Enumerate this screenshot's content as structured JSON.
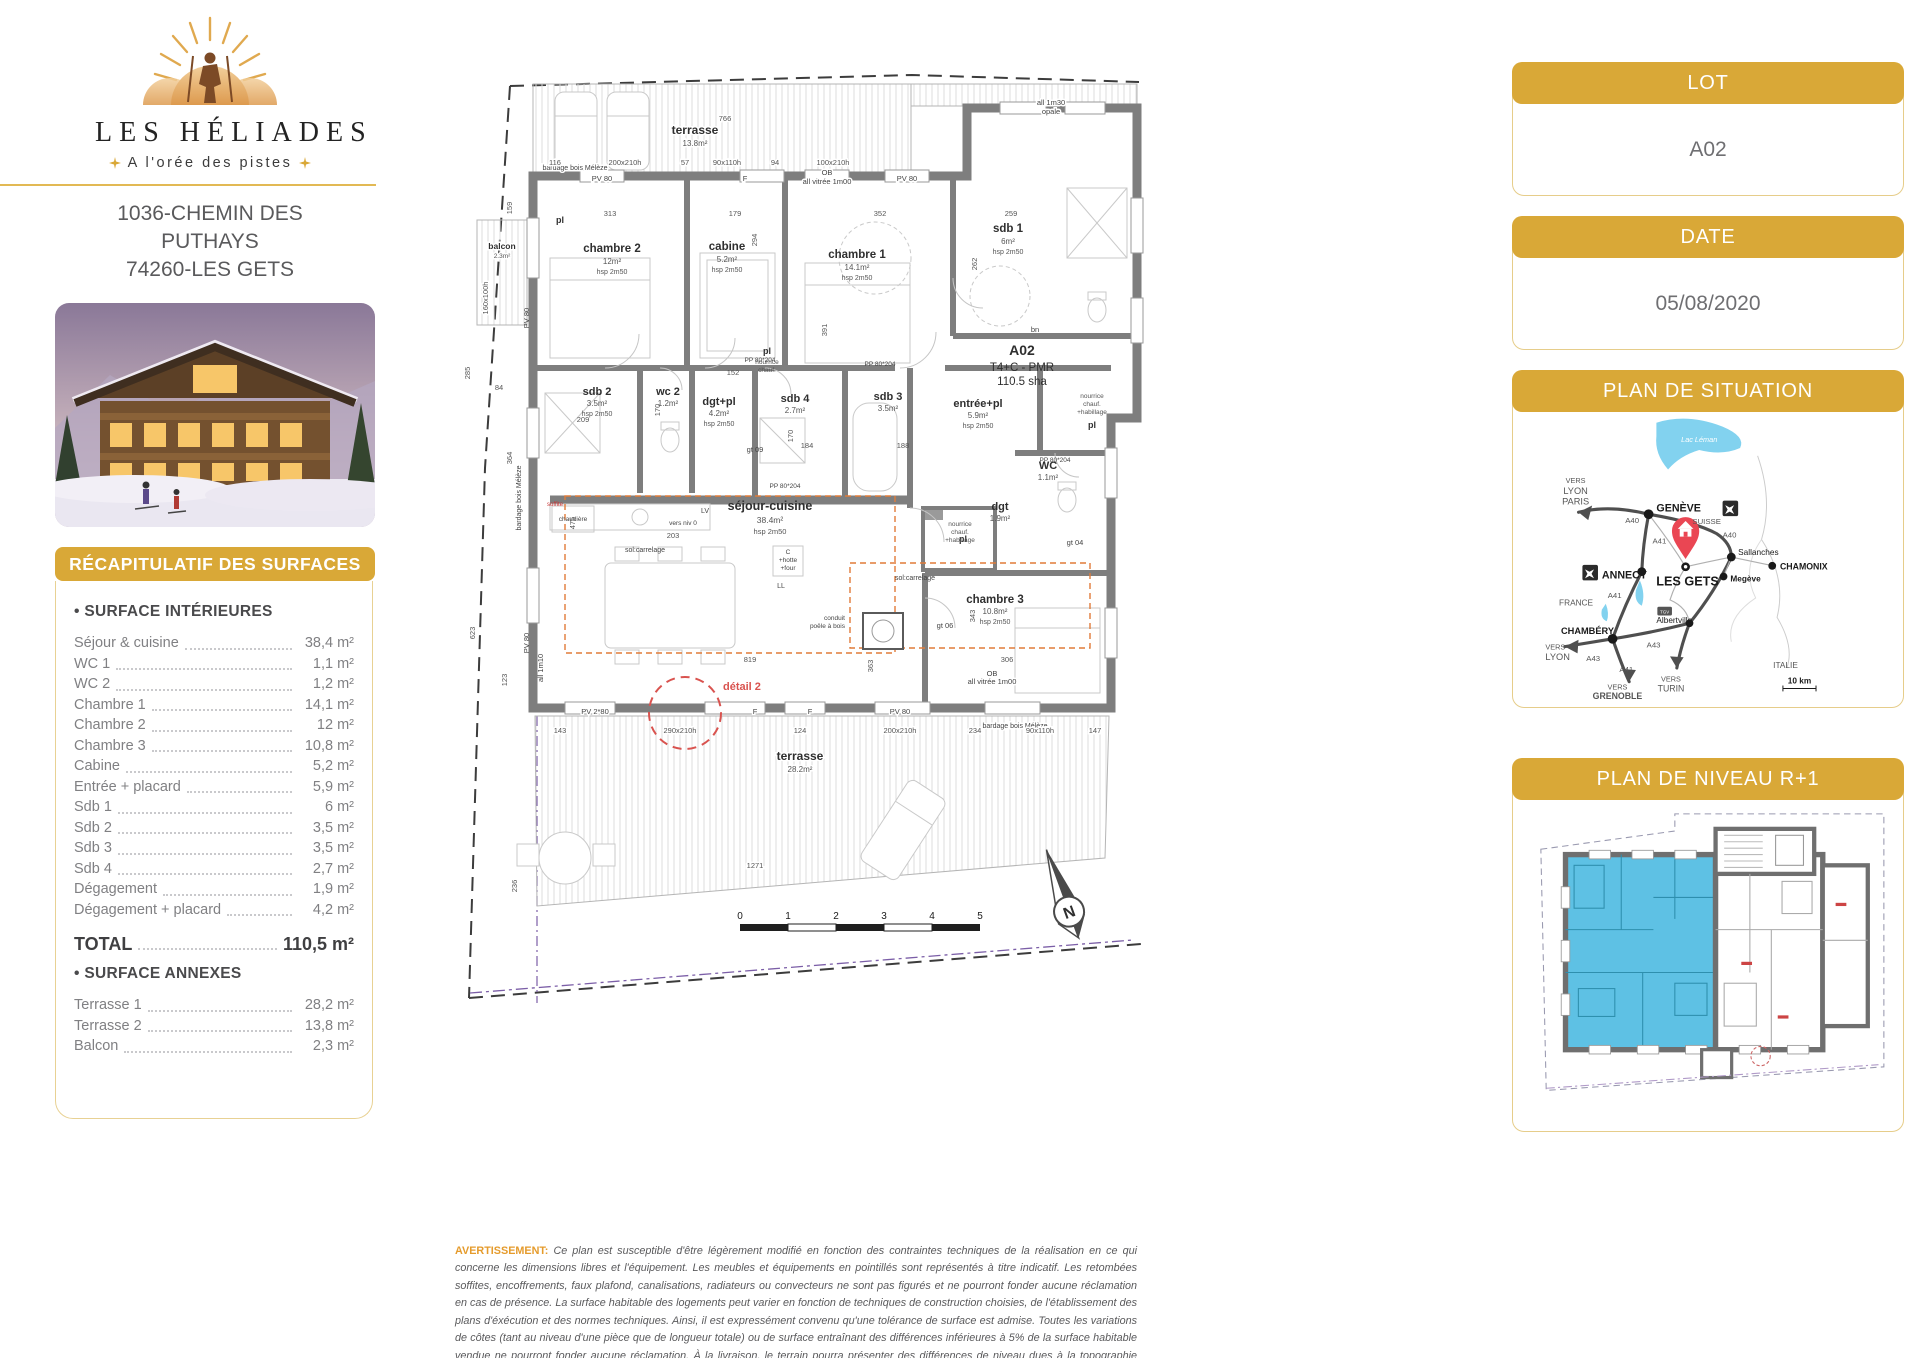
{
  "branding": {
    "name": "LES HÉLIADES",
    "tagline": "A l'orée des pistes",
    "address_line1": "1036-CHEMIN DES",
    "address_line2": "PUTHAYS",
    "address_line3": "74260-LES GETS"
  },
  "lot": {
    "header": "LOT",
    "value": "A02"
  },
  "date": {
    "header": "DATE",
    "value": "05/08/2020"
  },
  "situation": {
    "header": "PLAN DE SITUATION"
  },
  "niveau": {
    "header": "PLAN DE NIVEAU R+1"
  },
  "surfaces": {
    "title": "RÉCAPITULATIF DES SURFACES",
    "interior_heading": "• SURFACE INTÉRIEURES",
    "interior": [
      {
        "label": "Séjour & cuisine",
        "value": "38,4 m²"
      },
      {
        "label": "WC 1",
        "value": "1,1 m²"
      },
      {
        "label": "WC 2",
        "value": "1,2 m²"
      },
      {
        "label": "Chambre 1",
        "value": "14,1 m²"
      },
      {
        "label": "Chambre 2",
        "value": "12 m²"
      },
      {
        "label": "Chambre 3",
        "value": "10,8 m²"
      },
      {
        "label": "Cabine",
        "value": "5,2 m²"
      },
      {
        "label": "Entrée + placard",
        "value": "5,9 m²"
      },
      {
        "label": "Sdb 1",
        "value": "6 m²"
      },
      {
        "label": "Sdb 2",
        "value": "3,5 m²"
      },
      {
        "label": "Sdb 3",
        "value": "3,5 m²"
      },
      {
        "label": "Sdb 4",
        "value": "2,7 m²"
      },
      {
        "label": "Dégagement",
        "value": "1,9 m²"
      },
      {
        "label": "Dégagement + placard",
        "value": "4,2 m²"
      }
    ],
    "total_label": "TOTAL",
    "total_value": "110,5 m²",
    "annex_heading": "• SURFACE ANNEXES",
    "annex": [
      {
        "label": "Terrasse 1",
        "value": "28,2 m²"
      },
      {
        "label": "Terrasse 2",
        "value": "13,8 m²"
      },
      {
        "label": "Balcon",
        "value": "2,3 m²"
      }
    ]
  },
  "floorplan": {
    "unit": {
      "code": "A02",
      "type": "T4+C - PMR",
      "area": "110.5 sha"
    },
    "rooms": {
      "ch2": {
        "name": "chambre 2",
        "area": "12m²",
        "hsp": "hsp 2m50"
      },
      "cabine": {
        "name": "cabine",
        "area": "5.2m²",
        "hsp": "hsp 2m50"
      },
      "ch1": {
        "name": "chambre 1",
        "area": "14.1m²",
        "hsp": "hsp 2m50"
      },
      "sdb1": {
        "name": "sdb 1",
        "area": "6m²",
        "hsp": "hsp 2m50"
      },
      "sdb2": {
        "name": "sdb 2",
        "area": "3.5m²",
        "hsp": "hsp 2m50"
      },
      "wc2": {
        "name": "wc 2",
        "area": "1.2m²"
      },
      "dgtpl": {
        "name": "dgt+pl",
        "area": "4.2m²",
        "hsp": "hsp 2m50"
      },
      "sdb4": {
        "name": "sdb 4",
        "area": "2.7m²",
        "hsp": "hsp 2m50"
      },
      "sdb3": {
        "name": "sdb 3",
        "area": "3.5m²",
        "hsp": "hsp 2m50"
      },
      "entree": {
        "name": "entrée+pl",
        "area": "5.9m²",
        "hsp": "hsp 2m50"
      },
      "wc": {
        "name": "WC",
        "area": "1.1m²"
      },
      "dgt": {
        "name": "dgt",
        "area": "1.9m²"
      },
      "sejour": {
        "name": "séjour-cuisine",
        "area": "38.4m²",
        "hsp": "hsp 2m50"
      },
      "ch3": {
        "name": "chambre 3",
        "area": "10.8m²",
        "hsp": "hsp 2m50"
      }
    },
    "terrace_top": {
      "name": "terrasse",
      "area": "13.8m²"
    },
    "terrace_bottom": {
      "name": "terrasse",
      "area": "28.2m²"
    },
    "balcony": {
      "name": "balcon",
      "area": "2.3m²"
    },
    "ann": {
      "pl": "pl",
      "bn": "bn",
      "pv80": "PV 80",
      "pv280": "PV 2*80",
      "f": "F",
      "ob1": "OB",
      "ob2": "all vitrée 1m00",
      "all130a": "all 1m30",
      "all130b": "opale",
      "all110": "all 1m10",
      "bardage": "bardage bois Mélèze",
      "sol": "sol:carrelage",
      "chaudiere": "chaudière",
      "lv": "LV",
      "ll": "LL",
      "hotte1": "C",
      "hotte2": "+hotte",
      "hotte3": "+four",
      "conduit1": "conduit",
      "conduit2": "poêle à bois",
      "versniv": "vers niv 0",
      "soffite": "soffite",
      "detail": "détail 2",
      "pp": "PP 80*204",
      "nour1": "nourrice",
      "nour2": "chauf.",
      "nour3": "+habillage",
      "gt04": "gt 04",
      "gt06": "gt 06",
      "gt09": "gt 09"
    },
    "dims": {
      "d766": "766",
      "d1271": "1271",
      "d819": "819",
      "d116": "116",
      "d200": "200x210h",
      "d57": "57",
      "d90": "90x110h",
      "d94": "94",
      "d100": "100x210h",
      "d313": "313",
      "d179": "179",
      "d352": "352",
      "d259": "259",
      "d143": "143",
      "d290": "290x210h",
      "d124": "124",
      "d234": "234",
      "d147": "147",
      "d159": "159",
      "d285": "285",
      "d364": "364",
      "d623": "623",
      "d236": "236",
      "d123": "123",
      "d160": "160x100h",
      "d84": "84",
      "d294": "294",
      "d391": "391",
      "d262": "262",
      "d170": "170",
      "d209": "209",
      "d152": "152",
      "d184": "184",
      "d188": "188",
      "d306": "306",
      "d343": "343",
      "d363": "363",
      "d475": "475",
      "d203": "203"
    },
    "scale_ticks": [
      "0",
      "1",
      "2",
      "3",
      "4",
      "5"
    ],
    "north_letter": "N"
  },
  "map": {
    "lake": "Lac Léman",
    "vers": "VERS",
    "lyon": "LYON",
    "paris": "PARIS",
    "geneve": "GENÈVE",
    "suisse": "SUISSE",
    "a40": "A40",
    "a41": "A41",
    "a43": "A43",
    "sallanches": "Sallanches",
    "chamonix": "CHAMONIX",
    "megeve": "Megève",
    "annecy": "ANNECY",
    "les_gets": "LES GETS",
    "france": "FRANCE",
    "chambery": "CHAMBÉRY",
    "grenoble": "GRENOBLE",
    "turin": "TURIN",
    "albertville": "Albertville",
    "italie": "ITALIE",
    "scale": "10 km",
    "tgv": "TGV"
  },
  "disclaimer": {
    "label": "AVERTISSEMENT:",
    "text": "Ce plan est susceptible d'être légèrement modifié en fonction des contraintes techniques de la réalisation en ce qui concerne les dimensions libres et l'équipement. Les meubles et équipements en pointillés sont représentés à titre indicatif. Les retombées soffites, encoffrements, faux plafond, canalisations, radiateurs ou convecteurs ne sont pas figurés et ne pourront fonder aucune réclamation en cas de présence. La surface habitable des logements peut varier en fonction de techniques de construction choisies, de l'établissement des plans d'éxécution et des normes techniques. Ainsi, il est expressément convenu qu'une tolérance de surface est admise. Toutes les variations de côtes (tant au niveau d'une pièce que de longueur totale) ou de surface entraînant des différences inférieures à 5% de la surface habitable vendue ne pourront fonder aucune réclamation. À la livraison, le terrain pourra présenter des différences de niveau dues à la topographie naturelle du lieu, au calage des voiries, et aux contraintes techniques liées à la construction."
  }
}
